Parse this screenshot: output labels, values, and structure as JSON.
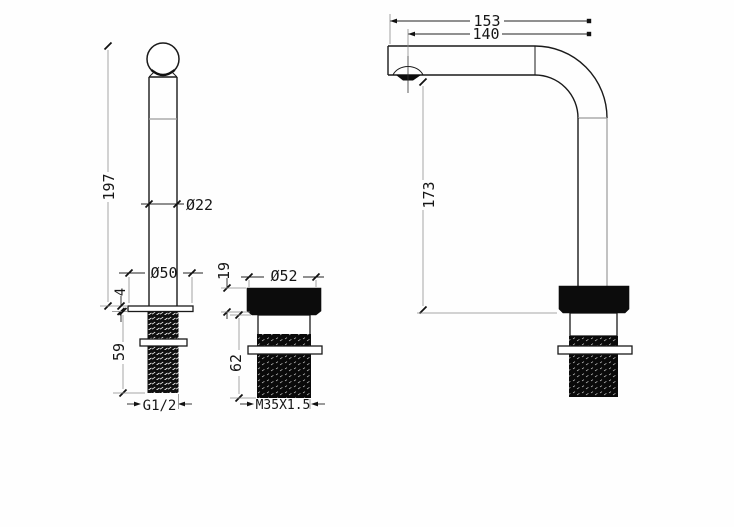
{
  "drawing": {
    "type": "faucet-dimensional-drawing",
    "colors": {
      "ink": "#1a1a1a",
      "soft_line": "#9a9a9a",
      "background": "#fefefe"
    },
    "labels": {
      "handle_height": "197",
      "handle_diameter": "Ø22",
      "flange_diameter": "Ø50",
      "flange_thickness": "4",
      "handle_thread_length": "59",
      "handle_thread_spec": "G1/2",
      "cap_height": "19",
      "cap_diameter": "Ø52",
      "body_length": "62",
      "body_thread_spec": "M35X1.5",
      "spout_reach_total": "153",
      "spout_reach_aerator": "140",
      "spout_height": "173"
    }
  }
}
